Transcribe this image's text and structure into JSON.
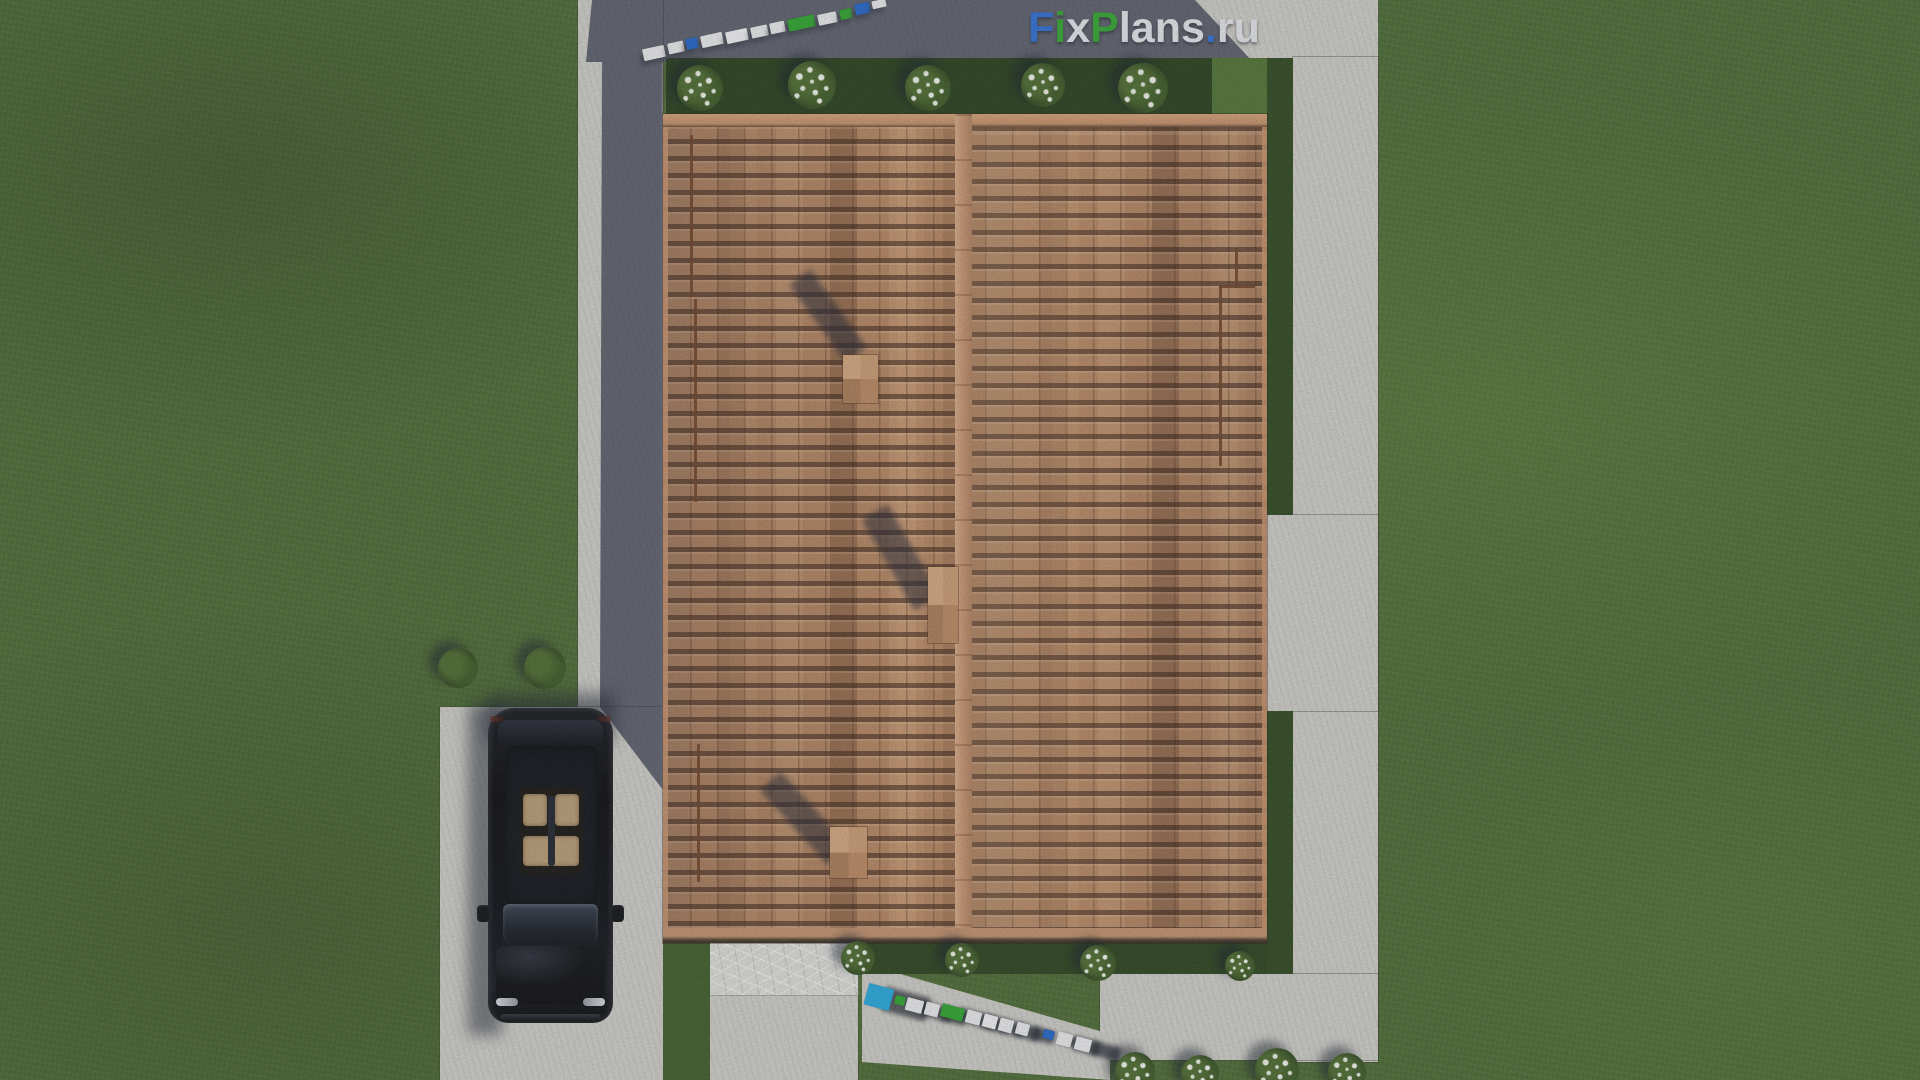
{
  "watermark": {
    "text": "FixPlans.ru",
    "segments": [
      {
        "text": "F",
        "color": "#2b6cd4"
      },
      {
        "text": "i",
        "color": "#2fa42d"
      },
      {
        "text": "x",
        "color": "#e2e5ea"
      },
      {
        "text": "P",
        "color": "#2fa42d"
      },
      {
        "text": "lans",
        "color": "#e2e5ea"
      },
      {
        "text": ".",
        "color": "#2b6cd4"
      },
      {
        "text": "ru",
        "color": "#e2e5ea"
      }
    ]
  },
  "palette": {
    "grass": "#486830",
    "garden_bed_dark": "#243c19",
    "pavement": "#cdccc8",
    "pavement_shadow": "#5a5f6e",
    "roof_tile": "#b3835f",
    "roof_ridge": "#c7946f",
    "marble": "#dadbd7",
    "car_body": "#0a0c10",
    "car_interior": "#bfa379",
    "brand_blue": "#2b6cd4",
    "brand_green": "#2fa42d",
    "brand_white": "#e2e5ea",
    "flower_white": "#eef2e8"
  },
  "ground_logos": {
    "top": {
      "angle_deg": -12,
      "shadow": {
        "dx": -3,
        "dy": 5,
        "color": "rgba(40,44,56,0.5)",
        "wscale": 1.1,
        "hscale": 1.0
      },
      "blocks": [
        {
          "x": 643,
          "y": 47,
          "w": 22,
          "h": 12,
          "color": "#e9eaec"
        },
        {
          "x": 668,
          "y": 42,
          "w": 16,
          "h": 11,
          "color": "#e9eaec"
        },
        {
          "x": 686,
          "y": 38,
          "w": 12,
          "h": 11,
          "color": "#1f63c8"
        },
        {
          "x": 701,
          "y": 34,
          "w": 22,
          "h": 12,
          "color": "#e9eaec"
        },
        {
          "x": 726,
          "y": 30,
          "w": 22,
          "h": 12,
          "color": "#f0f1f3"
        },
        {
          "x": 751,
          "y": 26,
          "w": 17,
          "h": 11,
          "color": "#e9eaec"
        },
        {
          "x": 770,
          "y": 22,
          "w": 15,
          "h": 11,
          "color": "#e9eaec"
        },
        {
          "x": 788,
          "y": 17,
          "w": 27,
          "h": 12,
          "color": "#2aa32a"
        },
        {
          "x": 818,
          "y": 13,
          "w": 19,
          "h": 11,
          "color": "#e9eaec"
        },
        {
          "x": 840,
          "y": 9,
          "w": 12,
          "h": 10,
          "color": "#2aa32a"
        },
        {
          "x": 855,
          "y": 3,
          "w": 15,
          "h": 11,
          "color": "#1f63c8"
        },
        {
          "x": 872,
          "y": 0,
          "w": 14,
          "h": 8,
          "color": "#e9eaec"
        }
      ]
    },
    "bottom": {
      "angle_deg": 15,
      "shadow": {
        "dx": 16,
        "dy": 6,
        "color": "rgba(32,37,46,0.72)",
        "wscale": 1.8,
        "hscale": 1.1
      },
      "blocks": [
        {
          "x": 866,
          "y": 986,
          "w": 26,
          "h": 22,
          "color": "#22a7dc"
        },
        {
          "x": 895,
          "y": 996,
          "w": 10,
          "h": 9,
          "color": "#2aa32a"
        },
        {
          "x": 906,
          "y": 999,
          "w": 17,
          "h": 13,
          "color": "#e9eaec"
        },
        {
          "x": 925,
          "y": 1003,
          "w": 14,
          "h": 13,
          "color": "#e9eaec"
        },
        {
          "x": 941,
          "y": 1006,
          "w": 23,
          "h": 13,
          "color": "#2aa32a"
        },
        {
          "x": 966,
          "y": 1011,
          "w": 15,
          "h": 13,
          "color": "#e9eaec"
        },
        {
          "x": 983,
          "y": 1015,
          "w": 14,
          "h": 13,
          "color": "#f0f1f3"
        },
        {
          "x": 999,
          "y": 1019,
          "w": 14,
          "h": 13,
          "color": "#e9eaec"
        },
        {
          "x": 1016,
          "y": 1023,
          "w": 13,
          "h": 12,
          "color": "#e9eaec"
        },
        {
          "x": 1043,
          "y": 1030,
          "w": 11,
          "h": 9,
          "color": "#1f63c8"
        },
        {
          "x": 1057,
          "y": 1033,
          "w": 15,
          "h": 13,
          "color": "#e9eaec"
        },
        {
          "x": 1075,
          "y": 1038,
          "w": 16,
          "h": 13,
          "color": "#e9eaec"
        }
      ]
    }
  },
  "vegetation": {
    "bushes": [
      {
        "x": 700,
        "y": 88,
        "size": 46,
        "variant": "flower"
      },
      {
        "x": 812,
        "y": 85,
        "size": 48,
        "variant": "flower"
      },
      {
        "x": 928,
        "y": 88,
        "size": 46,
        "variant": "flower"
      },
      {
        "x": 1043,
        "y": 85,
        "size": 44,
        "variant": "flower"
      },
      {
        "x": 1143,
        "y": 88,
        "size": 50,
        "variant": "flower"
      },
      {
        "x": 858,
        "y": 958,
        "size": 34,
        "variant": "flower"
      },
      {
        "x": 962,
        "y": 960,
        "size": 34,
        "variant": "flower"
      },
      {
        "x": 1098,
        "y": 963,
        "size": 36,
        "variant": "flower"
      },
      {
        "x": 1240,
        "y": 966,
        "size": 30,
        "variant": "flower"
      },
      {
        "x": 1135,
        "y": 1072,
        "size": 40,
        "variant": "flower"
      },
      {
        "x": 1200,
        "y": 1074,
        "size": 38,
        "variant": "flower"
      },
      {
        "x": 1277,
        "y": 1070,
        "size": 44,
        "variant": "flower"
      },
      {
        "x": 1347,
        "y": 1072,
        "size": 38,
        "variant": "flower"
      },
      {
        "x": 458,
        "y": 668,
        "size": 40,
        "variant": "green"
      },
      {
        "x": 545,
        "y": 668,
        "size": 42,
        "variant": "green"
      }
    ]
  },
  "structures": {
    "chimneys": [
      {
        "x": 843,
        "y": 355,
        "w": 35,
        "h": 48,
        "shadow": {
          "x": 815,
          "y": 268,
          "w": 26,
          "h": 96,
          "rot": -36
        }
      },
      {
        "x": 928,
        "y": 567,
        "w": 30,
        "h": 76,
        "shadow": {
          "x": 886,
          "y": 505,
          "w": 30,
          "h": 105,
          "rot": -30
        }
      },
      {
        "x": 830,
        "y": 827,
        "w": 37,
        "h": 51,
        "shadow": {
          "x": 790,
          "y": 768,
          "w": 28,
          "h": 100,
          "rot": -42
        }
      }
    ],
    "roof_rails": [
      {
        "x": 690,
        "y": 135,
        "w": 3,
        "h": 162
      },
      {
        "x": 694,
        "y": 299,
        "w": 3,
        "h": 203
      },
      {
        "x": 697,
        "y": 744,
        "w": 3,
        "h": 138
      },
      {
        "x": 1219,
        "y": 286,
        "w": 3,
        "h": 180
      },
      {
        "x": 1235,
        "y": 248,
        "w": 3,
        "h": 40
      },
      {
        "x": 1219,
        "y": 285,
        "w": 36,
        "h": 3
      }
    ]
  }
}
